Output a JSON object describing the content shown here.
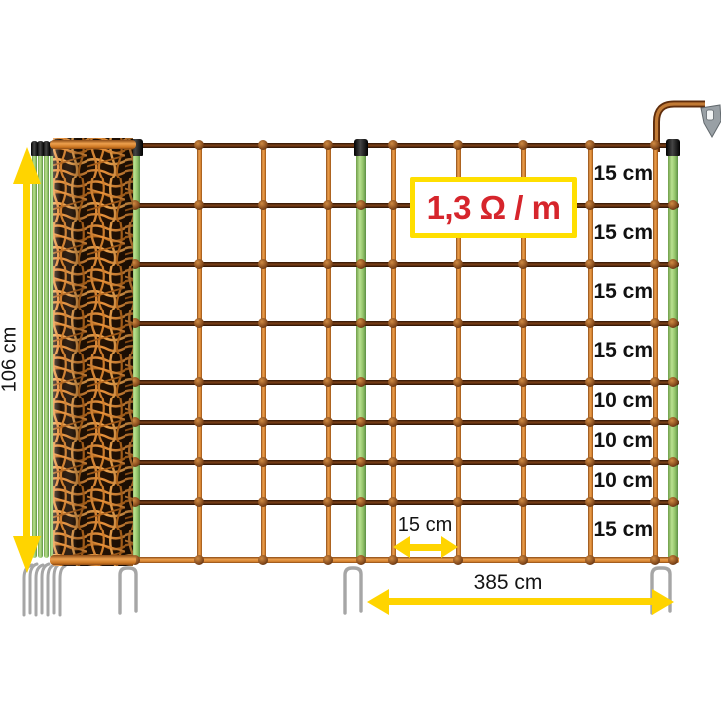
{
  "diagram": {
    "badge_text": "1,3 Ω / m",
    "height_label": "106 cm",
    "length_label": "385 cm",
    "mesh_width_label": "15 cm",
    "row_spacing_labels": [
      "15 cm",
      "15 cm",
      "15 cm",
      "15 cm",
      "10 cm",
      "10 cm",
      "10 cm",
      "15 cm"
    ]
  },
  "colors": {
    "dimension_yellow": "#ffd400",
    "badge_border_yellow": "#ffdf00",
    "badge_text_red": "#d6252c",
    "label_black": "#141414",
    "net_orange": "#e0883c",
    "conductor_brown": "#5a2e10",
    "post_green": "#9cc973",
    "spike_gray": "#a6a6a6",
    "cap_black": "#1c1c1c"
  },
  "icons": {
    "connection_clip": "spade-terminal-clip-icon"
  }
}
